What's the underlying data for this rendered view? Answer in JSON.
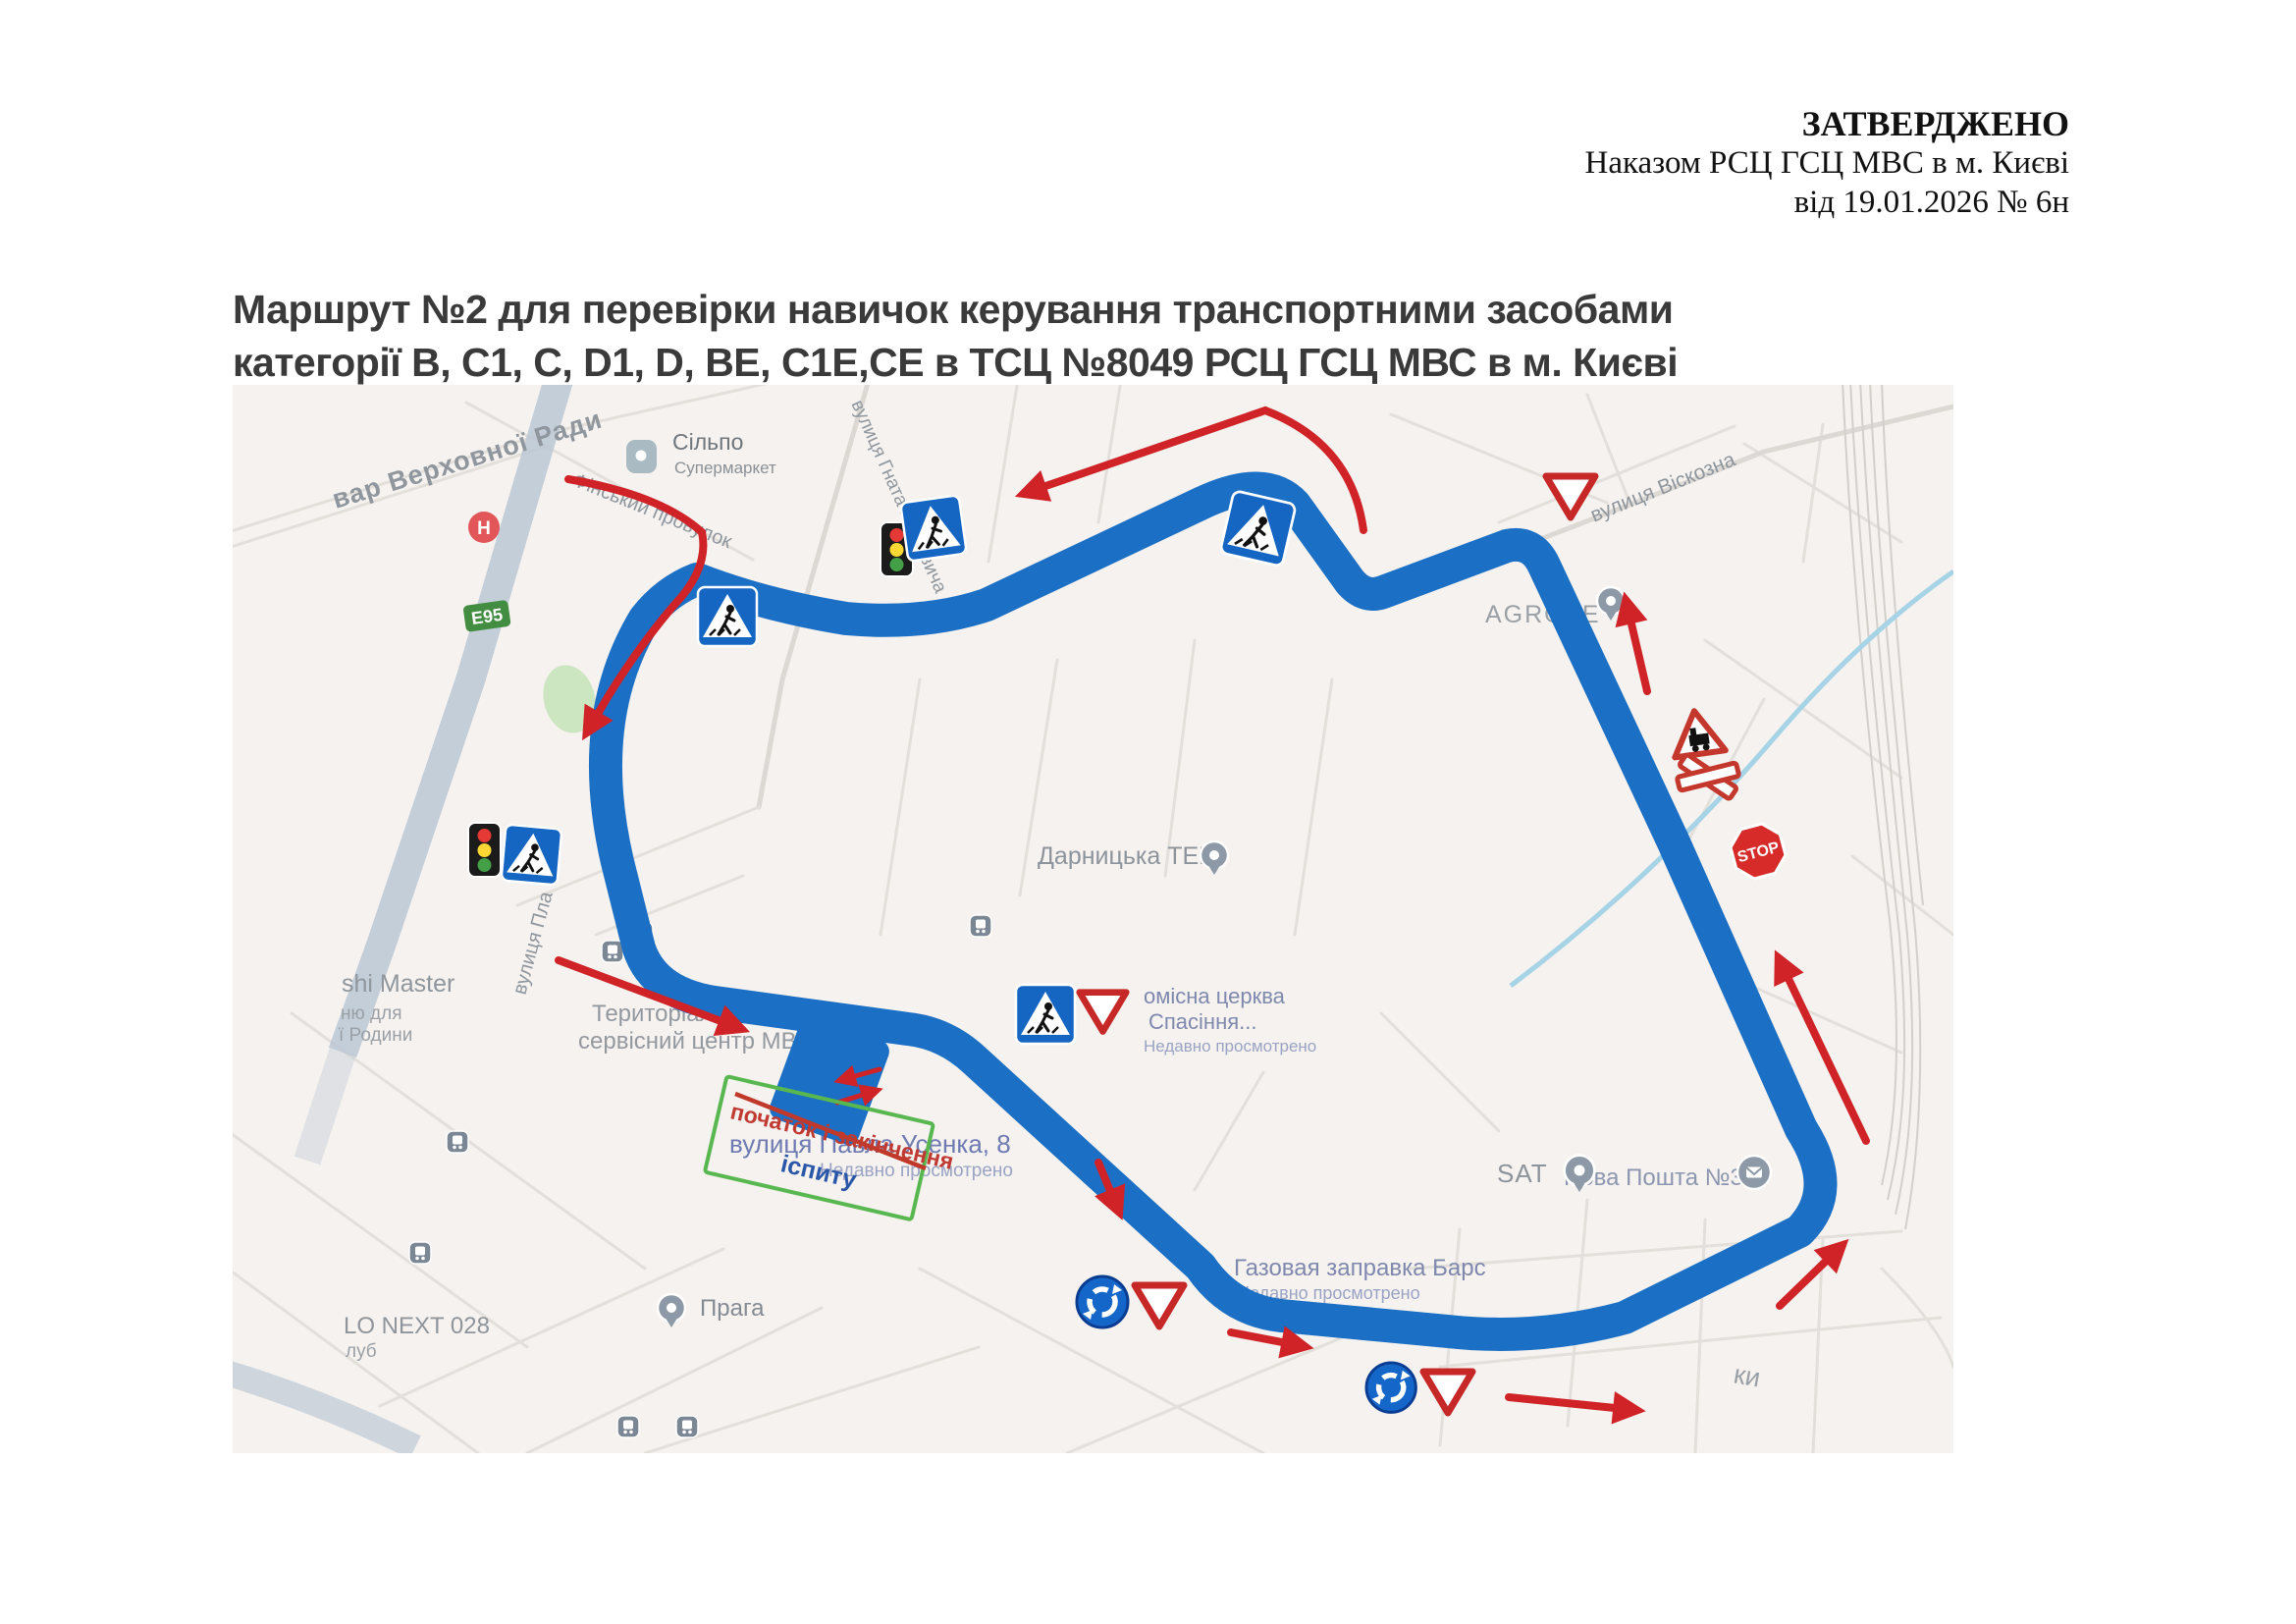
{
  "approval": {
    "l1": "ЗАТВЕРДЖЕНО",
    "l2": "Наказом РСЦ ГСЦ МВС в м. Києві",
    "l3": "від 19.01.2026 № 6н"
  },
  "title": {
    "l1": "Маршрут №2 для перевірки навичок керування транспортними засобами",
    "l2": "категорії B, C1, C, D1, D, BE, C1E,CE в ТСЦ №8049 РСЦ ГСЦ МВС в м. Києві"
  },
  "map": {
    "labels": {
      "verkhovna": "вар Верховної Ради",
      "silpo": "Сільпо",
      "silpo_sub": "Супермаркет",
      "finskyi": "Фінський провулок",
      "hotkevycha": "вулиця Гната Хоткевича",
      "e95": "E95",
      "viskozna": "вулиця Віскозна",
      "agrotech": "AGROTE",
      "tec": "Дарницька ТЕЦ",
      "vul_pla": "вулиця Пла",
      "sushi1": "shi Master",
      "sushi2": "ню для",
      "sushi3": "ї Родини",
      "tsc1": "Територіальни",
      "tsc2": "сервісний центр МВС",
      "usenka": "вулиця Павла Усенка, 8",
      "usenka_sub": "Недавно просмотрено",
      "church1": "омісна церква",
      "church2": "Спасіння...",
      "church3": "Недавно просмотрено",
      "praha": "Прага",
      "gas": "Газовая заправка Барс",
      "gas_sub": "Недавно просмотрено",
      "sat": "SAT",
      "poshta": "Нова Пошта №3",
      "velo": "LO NEXT 028",
      "klub": "луб",
      "partial": "ки",
      "stop": "STOP",
      "h_icon": "H"
    },
    "overlay": {
      "start1": "початок і закінчення",
      "start2": "іспиту"
    },
    "colors": {
      "route": "#1b6fc4",
      "arrow": "#d02328",
      "sign_blue": "#1565c3",
      "give_way_red": "#c62828",
      "green_box": "#58b84f",
      "overlay_red": "#c03a32",
      "overlay_blue": "#2b57a8"
    }
  }
}
